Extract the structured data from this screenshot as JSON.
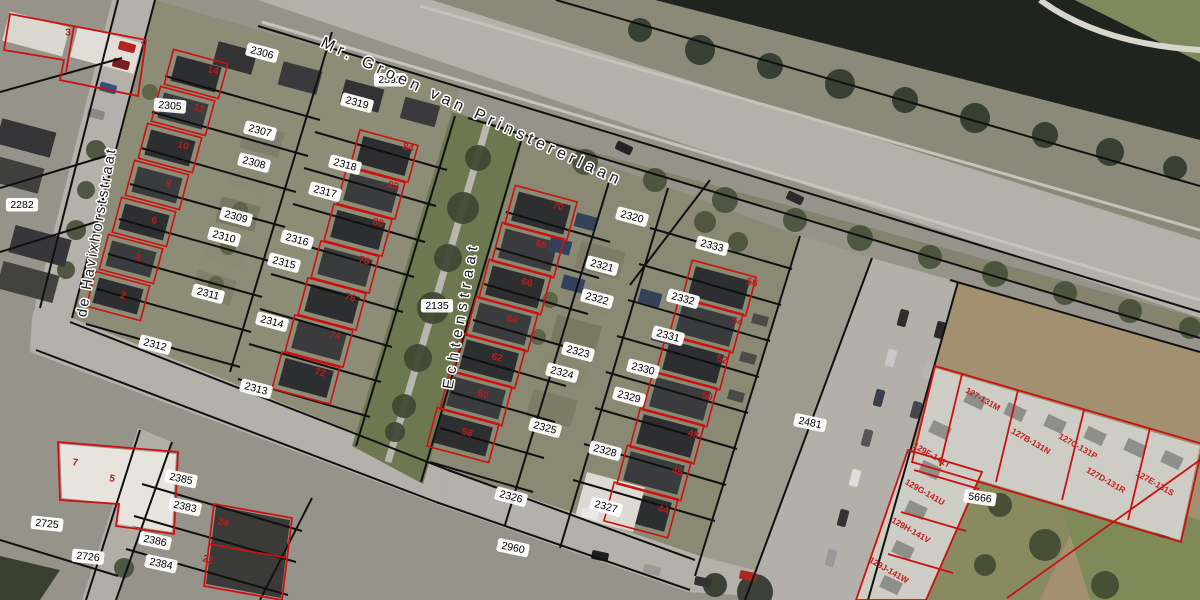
{
  "map": {
    "type": "cadastral-aerial-viewer",
    "colors": {
      "water": "#20241e",
      "road": "#b3b1a9",
      "green_strip": "#6e7850",
      "field": "#a29070",
      "parcel_line": "#111111",
      "building_outline": "#cc1111",
      "house_number": "#b91c1c",
      "label_bg": "#ffffff",
      "label_text": "#000000",
      "roof_dark": "#2d2e30",
      "apartment_roof": "#cdccc5"
    },
    "street_labels": [
      {
        "t": "Mr. Groen van Prinstererlaan",
        "x": 472,
        "y": 112,
        "r": 25,
        "fs": 16,
        "ls": 4.5
      },
      {
        "t": "de Havixhorststraat",
        "x": 97,
        "y": 232,
        "r": -80,
        "fs": 14.5,
        "ls": 2.5
      },
      {
        "t": "Echtenstraat",
        "x": 461,
        "y": 315,
        "r": -80,
        "fs": 15,
        "ls": 5.5
      }
    ],
    "parcel_labels": [
      {
        "t": "2592",
        "x": 390,
        "y": 80,
        "r": 0
      },
      {
        "t": "2306",
        "x": 262,
        "y": 53,
        "r": 15
      },
      {
        "t": "2305",
        "x": 170,
        "y": 106,
        "r": 5
      },
      {
        "t": "2282",
        "x": 22,
        "y": 205,
        "r": 0
      },
      {
        "t": "2307",
        "x": 260,
        "y": 131,
        "r": 15
      },
      {
        "t": "2308",
        "x": 254,
        "y": 163,
        "r": 15
      },
      {
        "t": "2309",
        "x": 236,
        "y": 217,
        "r": 15
      },
      {
        "t": "2310",
        "x": 224,
        "y": 237,
        "r": 15
      },
      {
        "t": "2311",
        "x": 208,
        "y": 294,
        "r": 15
      },
      {
        "t": "2312",
        "x": 155,
        "y": 345,
        "r": 15
      },
      {
        "t": "2313",
        "x": 256,
        "y": 389,
        "r": 15
      },
      {
        "t": "2314",
        "x": 272,
        "y": 322,
        "r": 15
      },
      {
        "t": "2315",
        "x": 284,
        "y": 263,
        "r": 15
      },
      {
        "t": "2316",
        "x": 297,
        "y": 240,
        "r": 15
      },
      {
        "t": "2317",
        "x": 325,
        "y": 192,
        "r": 15
      },
      {
        "t": "2318",
        "x": 345,
        "y": 165,
        "r": 15
      },
      {
        "t": "2319",
        "x": 357,
        "y": 103,
        "r": 15
      },
      {
        "t": "2135",
        "x": 437,
        "y": 306,
        "r": 0
      },
      {
        "t": "2320",
        "x": 632,
        "y": 217,
        "r": 15
      },
      {
        "t": "2321",
        "x": 602,
        "y": 266,
        "r": 15
      },
      {
        "t": "2322",
        "x": 597,
        "y": 299,
        "r": 15
      },
      {
        "t": "2323",
        "x": 578,
        "y": 352,
        "r": 15
      },
      {
        "t": "2324",
        "x": 562,
        "y": 373,
        "r": 15
      },
      {
        "t": "2325",
        "x": 545,
        "y": 428,
        "r": 15
      },
      {
        "t": "2326",
        "x": 511,
        "y": 497,
        "r": 15
      },
      {
        "t": "2327",
        "x": 606,
        "y": 507,
        "r": 15
      },
      {
        "t": "2328",
        "x": 605,
        "y": 451,
        "r": 15
      },
      {
        "t": "2329",
        "x": 629,
        "y": 397,
        "r": 15
      },
      {
        "t": "2330",
        "x": 643,
        "y": 369,
        "r": 15
      },
      {
        "t": "2331",
        "x": 668,
        "y": 336,
        "r": 15
      },
      {
        "t": "2332",
        "x": 683,
        "y": 299,
        "r": 15
      },
      {
        "t": "2333",
        "x": 712,
        "y": 246,
        "r": 15
      },
      {
        "t": "2481",
        "x": 810,
        "y": 423,
        "r": 12
      },
      {
        "t": "2960",
        "x": 513,
        "y": 548,
        "r": 12
      },
      {
        "t": "5666",
        "x": 980,
        "y": 498,
        "r": 8
      },
      {
        "t": "2725",
        "x": 47,
        "y": 524,
        "r": 6
      },
      {
        "t": "2726",
        "x": 88,
        "y": 557,
        "r": 6
      },
      {
        "t": "2385",
        "x": 181,
        "y": 479,
        "r": 12
      },
      {
        "t": "2383",
        "x": 185,
        "y": 507,
        "r": 12
      },
      {
        "t": "2386",
        "x": 155,
        "y": 541,
        "r": 12
      },
      {
        "t": "2384",
        "x": 161,
        "y": 564,
        "r": 12
      }
    ],
    "house_numbers": [
      {
        "t": "3",
        "x": 68,
        "y": 33,
        "r": 0
      },
      {
        "t": "1",
        "x": 143,
        "y": 46,
        "r": 0
      },
      {
        "t": "14",
        "x": 213,
        "y": 71,
        "r": 15
      },
      {
        "t": "12",
        "x": 199,
        "y": 109,
        "r": 15
      },
      {
        "t": "10",
        "x": 183,
        "y": 146,
        "r": 15
      },
      {
        "t": "8",
        "x": 168,
        "y": 184,
        "r": 15
      },
      {
        "t": "6",
        "x": 154,
        "y": 221,
        "r": 15
      },
      {
        "t": "4",
        "x": 138,
        "y": 258,
        "r": 15
      },
      {
        "t": "2",
        "x": 123,
        "y": 296,
        "r": 15
      },
      {
        "t": "84",
        "x": 408,
        "y": 148,
        "r": 15
      },
      {
        "t": "82",
        "x": 393,
        "y": 186,
        "r": 15
      },
      {
        "t": "80",
        "x": 378,
        "y": 223,
        "r": 15
      },
      {
        "t": "78",
        "x": 364,
        "y": 261,
        "r": 15
      },
      {
        "t": "76",
        "x": 350,
        "y": 298,
        "r": 15
      },
      {
        "t": "74",
        "x": 335,
        "y": 336,
        "r": 15
      },
      {
        "t": "72",
        "x": 320,
        "y": 373,
        "r": 15
      },
      {
        "t": "70",
        "x": 558,
        "y": 207,
        "r": 15
      },
      {
        "t": "68",
        "x": 541,
        "y": 245,
        "r": 15
      },
      {
        "t": "66",
        "x": 527,
        "y": 283,
        "r": 15
      },
      {
        "t": "64",
        "x": 512,
        "y": 320,
        "r": 15
      },
      {
        "t": "62",
        "x": 497,
        "y": 358,
        "r": 15
      },
      {
        "t": "60",
        "x": 483,
        "y": 395,
        "r": 15
      },
      {
        "t": "58",
        "x": 467,
        "y": 433,
        "r": 15
      },
      {
        "t": "56",
        "x": 752,
        "y": 283,
        "r": 15
      },
      {
        "t": "54",
        "x": 737,
        "y": 322,
        "r": 15
      },
      {
        "t": "52",
        "x": 722,
        "y": 360,
        "r": 15
      },
      {
        "t": "50",
        "x": 707,
        "y": 397,
        "r": 15
      },
      {
        "t": "48",
        "x": 693,
        "y": 435,
        "r": 15
      },
      {
        "t": "46",
        "x": 677,
        "y": 472,
        "r": 15
      },
      {
        "t": "44",
        "x": 663,
        "y": 510,
        "r": 15
      },
      {
        "t": "7",
        "x": 75,
        "y": 463,
        "r": 10
      },
      {
        "t": "5",
        "x": 112,
        "y": 479,
        "r": 10
      },
      {
        "t": "24",
        "x": 223,
        "y": 523,
        "r": 15
      },
      {
        "t": "22",
        "x": 208,
        "y": 560,
        "r": 15
      }
    ],
    "apartment_labels": [
      {
        "t": "127-131M",
        "x": 983,
        "y": 399,
        "r": 30
      },
      {
        "t": "127B-131N",
        "x": 1031,
        "y": 441,
        "r": 30
      },
      {
        "t": "127C-131P",
        "x": 1078,
        "y": 446,
        "r": 30
      },
      {
        "t": "127D-131R",
        "x": 1106,
        "y": 480,
        "r": 30
      },
      {
        "t": "127E-131S",
        "x": 1155,
        "y": 483,
        "r": 30
      },
      {
        "t": "129F-141T",
        "x": 932,
        "y": 455,
        "r": 30
      },
      {
        "t": "129G-141U",
        "x": 925,
        "y": 492,
        "r": 30
      },
      {
        "t": "129H-141V",
        "x": 911,
        "y": 530,
        "r": 30
      },
      {
        "t": "129J-141W",
        "x": 889,
        "y": 570,
        "r": 30
      }
    ]
  }
}
